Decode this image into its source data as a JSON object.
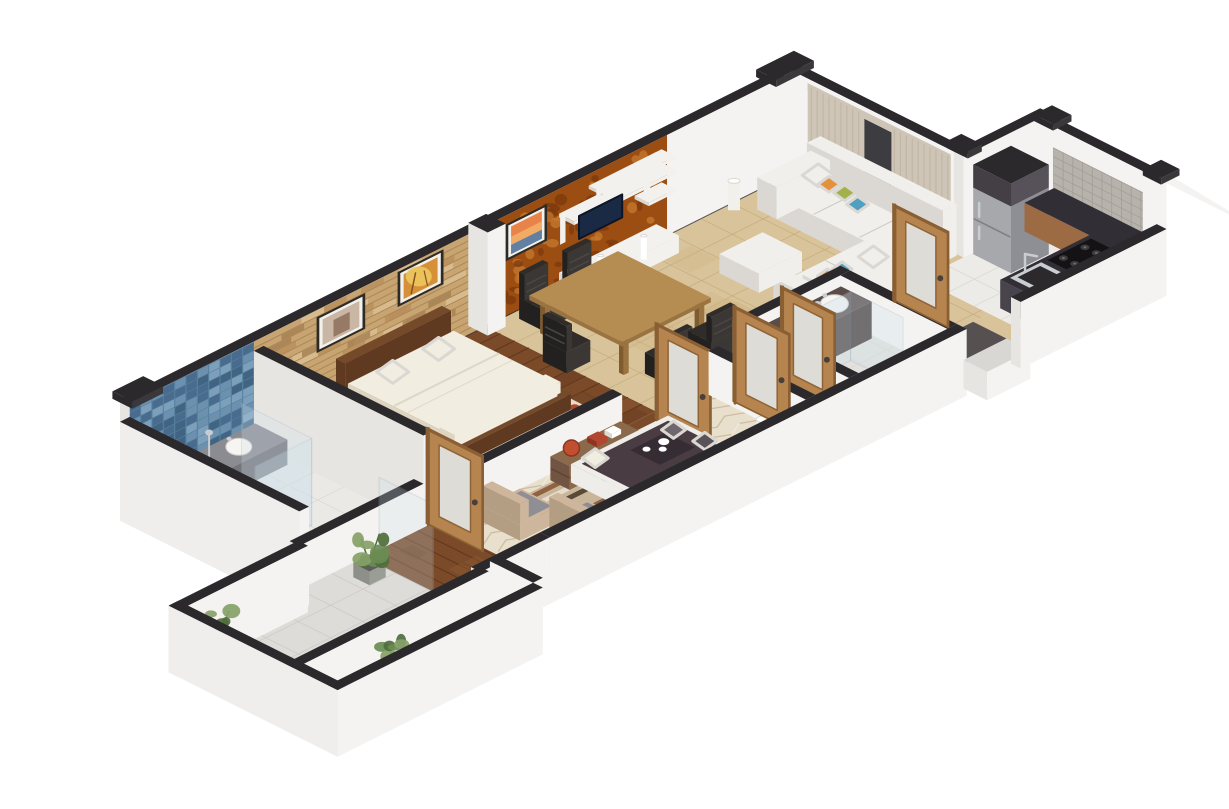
{
  "scene": {
    "label": "Isometric 3D rendered floor plan of an apartment with bedroom, two bathrooms, lounge, living-dining room, kitchen and plant-lined balcony",
    "background": "#ffffff",
    "balcony_plants": 3,
    "doors": {
      "count": 5,
      "style": "wood-frame-frosted-glass"
    },
    "rooms": [
      {
        "name": "bathroom-1",
        "floor": "light-tile",
        "accent_wall": "blue-mosaic",
        "items": [
          "gray-vanity",
          "vessel-sink",
          "glass-shower",
          "toilet"
        ]
      },
      {
        "name": "bedroom",
        "floor": "walnut-plank",
        "accent_wall": "tan-brick",
        "items": [
          "double-bed",
          "two-pillows",
          "cream-rug",
          "two-framed-paintings"
        ]
      },
      {
        "name": "lounge",
        "floor": "herringbone-parquet",
        "items": [
          "dark-daybed",
          "serving-tray",
          "striped-rug",
          "two-armchairs",
          "console-shelf",
          "floor-lamps"
        ]
      },
      {
        "name": "living-dining",
        "floor": "beige-tile",
        "accent_wall": "orange-damask",
        "items": [
          "dining-table",
          "five-chairs",
          "tv-shelf-unit",
          "framed-painting",
          "white-corner-sofa",
          "color-pillows",
          "ottoman",
          "curtained-window"
        ]
      },
      {
        "name": "bathroom-2",
        "floor": "gray-tile",
        "items": [
          "dark-double-vanity",
          "two-sinks",
          "glass-shower"
        ]
      },
      {
        "name": "kitchen",
        "floor": "white-tile",
        "items": [
          "refrigerator",
          "upper-dark-cabinet",
          "l-shaped-counter",
          "gas-hob",
          "sink",
          "wood-cabinet",
          "mosaic-backsplash"
        ]
      },
      {
        "name": "balcony",
        "floor": "stone-tile",
        "items": [
          "potted-plant",
          "potted-plant",
          "potted-plant",
          "parapet-walls"
        ]
      }
    ],
    "colors": {
      "cap": "#2b292c",
      "wallLight": "#f4f3f1",
      "wallMid": "#e7e5e2",
      "wallShade": "#dbd8d4",
      "floorBath": "#eae9e6",
      "gridBath": "#d8d6d2",
      "mosaicBase": "#57819f",
      "mosaic1": "#47678a",
      "mosaic2": "#6f94b2",
      "mosaic3": "#3e5f7e",
      "mosaic4": "#82a6c0",
      "brickBase": "#c8a471",
      "brick1": "#b98e5b",
      "brick2": "#dcc094",
      "brick3": "#a57e50",
      "brickLine": "#8f7148",
      "orangeBase": "#9c4e12",
      "damask1": "#c47a2e",
      "damask2": "#7c3a0c",
      "woodFloor": "#7a4a29",
      "woodPlankA": "#8d5a33",
      "woodPlankB": "#693e22",
      "woodLine": "#54301a",
      "tileBeige": "#d9c39a",
      "tileBeigeLine": "#c1a878",
      "tileMottle": "#cdb584",
      "herringBase": "#e8dfcd",
      "herringA": "#cbb89c",
      "herringB": "#f6f1e6",
      "tileWhite": "#edebe7",
      "tileWhiteLine": "#d9d6d1",
      "balconyTile": "#dedcd8",
      "balconyLine": "#c9c7c2",
      "darkFloor": "#565150",
      "curtain": "#cfc5b7",
      "curtainFold": "#b4a796",
      "windowGlass": "#3c3c41",
      "paintFrame": "#2e2a26",
      "matWhite": "#f3f1ec",
      "art1a": "#c9b6a4",
      "art1b": "#8a6b55",
      "art2a": "#d69037",
      "art2b": "#ecc75f",
      "art2c": "#7a4a1e",
      "art3a": "#e8834a",
      "art3b": "#f2b36a",
      "art3c": "#5a7fa8",
      "shelfWhite": "#f2f1ee",
      "tvScreen": "#1b2a44",
      "sofaWhite": "#f1efec",
      "sofaShade": "#dbd8d3",
      "sofaDark": "#c8c4be",
      "pillowOrange": "#e2913d",
      "pillowGreen": "#a1b24a",
      "pillowTeal": "#4f9fc0",
      "tableWood": "#b58c52",
      "tableSide": "#9a7440",
      "chairDark": "#2f2c2a",
      "fridgeFace": "#a7a8ac",
      "fridgeSide": "#8e8f94",
      "fridgeTop": "#3a373a",
      "counterTop": "#322e35",
      "counterFace": "#49444b",
      "cabinetWood": "#9c6b44",
      "backsplash": "#b7b2ac",
      "backsplashLine": "#9e9992",
      "steel": "#c9ccd1",
      "vanityGray": "#75757c",
      "vanityTop": "#8b8b92",
      "vanity2": "#4a3e3c",
      "vanity2Top": "#5a4c49",
      "sinkWhite": "#f6f5f2",
      "glass": "#cfe2ec",
      "glassFrame": "#9fb2bd",
      "bedWood": "#5f3a20",
      "bedWoodTop": "#744a2a",
      "bedding": "#f2ede1",
      "beddingShade": "#ddd5c2",
      "rugCream": "#ece2d0",
      "rugRed": "#b2462e",
      "rugTan": "#c89a62",
      "stripeA": "#8a5c39",
      "stripeB": "#c9b69a",
      "stripeC": "#50402f",
      "stripeD": "#e9dfd0",
      "daybedDark": "#4a3c43",
      "daybedBase": "#efedea",
      "trayDark": "#352d33",
      "armFrame": "#cdb69b",
      "armFrameShade": "#b49e83",
      "armCushion": "#8e8e94",
      "consoleWood": "#8a6a4a",
      "consoleSide": "#715441",
      "plantGreen1": "#4f6e3c",
      "plantGreen2": "#6a8c52",
      "plantGreen3": "#86a268",
      "potGray": "#8d9089",
      "potDark": "#5c5e59",
      "doorWood": "#b6854f",
      "doorFrame": "#8a5f33",
      "doorGlass": "#e3e8ea",
      "doorHandle": "#4a4038",
      "lampWhite": "#f2f0ea",
      "white": "#ffffff"
    }
  }
}
